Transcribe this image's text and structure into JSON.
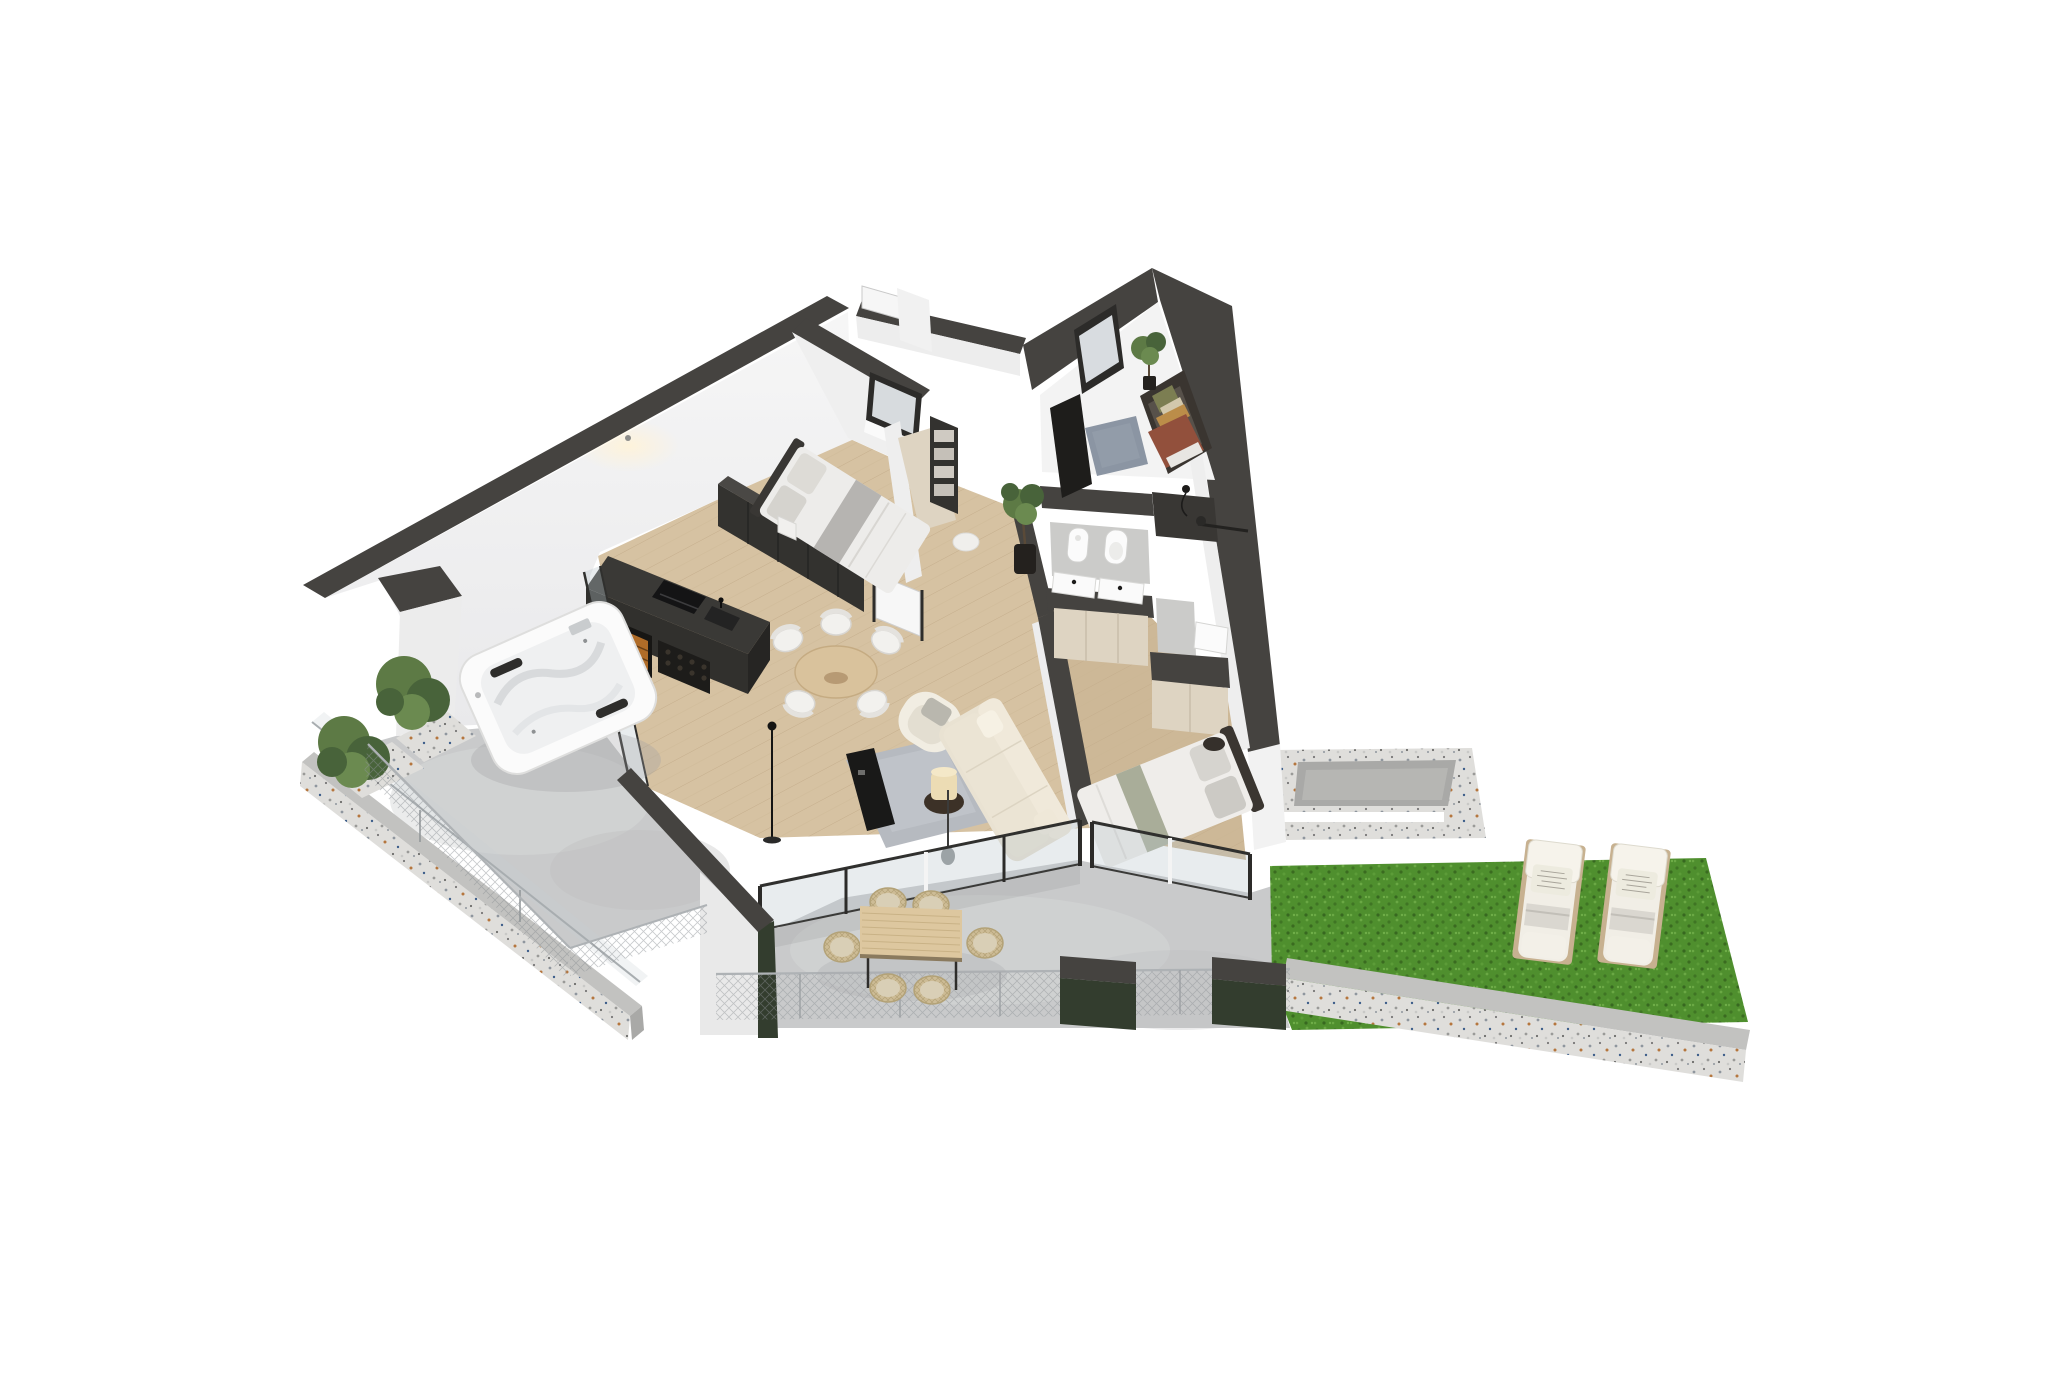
{
  "title": "3D isometric floor plan rendering of a modern apartment with terraces, jacuzzi and garden",
  "palette": {
    "bg": "#ffffff",
    "wallDark": "#454340",
    "wallDarker": "#393734",
    "wallWhite": "#f4f4f4",
    "wallShade": "#e7e7e9",
    "woodFloor": "#d6c2a2",
    "woodFloor2": "#cdb897",
    "studyFloor": "#8a7b68",
    "concrete": "#c9cacb",
    "concreteLight": "#d6d7d8",
    "terrazzo": "#dfdedb",
    "terrazzoShade": "#c2c2c0",
    "terrazzoDark": "#a9a9a7",
    "grass": "#4f8f2e",
    "greenWall": "#333d2e",
    "frameDark": "#2c2b29",
    "glassTint": "rgba(185,197,203,0.33)",
    "islandDark": "#31302d",
    "islandSide": "#262523",
    "wardrobeDark": "#33322f",
    "bedWhite": "#edecea",
    "bedGray": "#b6b4b1",
    "cream": "#e9e2d2",
    "creamLight": "#f1ede2",
    "rugGray": "#b6bac0",
    "rugBlue": "#8b95a3",
    "consoleBlack": "#191918",
    "lampShade": "#ecdcb4",
    "tableWood": "#d9c29c",
    "outdoorWood": "#ddc79f",
    "wicker": "#cdbc96",
    "wickerCushion": "#d9cfb6",
    "daybedDark": "#3a3530",
    "rustThrow": "#92503c",
    "pillowGreen": "#7c7e52",
    "pillowBeige": "#d2c8ac",
    "bolsterOrange": "#bb8d49",
    "runnerSage": "#a9ad99",
    "cabinetBeige": "#ded4c2",
    "tileGray": "#cbcbc9",
    "fixtureWhite": "#fbfbfb",
    "loungerCushion": "#f1eee6",
    "loungerBase": "#c7b190",
    "plantGreen": "#5d7a45",
    "plantDark": "#48633a",
    "meshGray": "#8d9296",
    "potDark": "#24211e",
    "glow": "#fff3d8"
  },
  "rooms": {
    "living": "Living and dining room",
    "kitchen": "Kitchen",
    "bedroom1": "Bedroom 1",
    "bedroom2": "Bedroom 2",
    "study": "Study guest room",
    "bathroom": "Bathroom",
    "hallway": "Hallway",
    "jacuzziTerrace": "Jacuzzi terrace",
    "diningTerrace": "Outdoor dining terrace",
    "garden": "Garden with sun loungers"
  },
  "labels": {
    "jacuzzi": "White outdoor jacuzzi hot tub",
    "kitchenIsland": "Dark kitchen island with hob, sink and wine cooler",
    "wardrobe": "Charcoal wardrobe row",
    "bed1": "Double bed with grey bedding",
    "bed2": "Double bed with sage runner",
    "sofa": "Cream three seater sofa",
    "armchair": "White boucle armchair",
    "diningTable": "Round wooden dining table with white chairs",
    "outdoorTable": "Rectangular outdoor dining table with six wicker chairs",
    "daybed": "Dark daybed with pillows and rust throw",
    "bidet": "Bidet",
    "toilet": "Wall hung toilet",
    "vanity": "Double vanity basins",
    "loungers": "Two white sun loungers on lawn",
    "planter": "Terrazzo planter ring",
    "grassLawn": "Artificial grass lawn",
    "fence": "Wire mesh fence",
    "shrubs": "Green shrubs in planters"
  }
}
